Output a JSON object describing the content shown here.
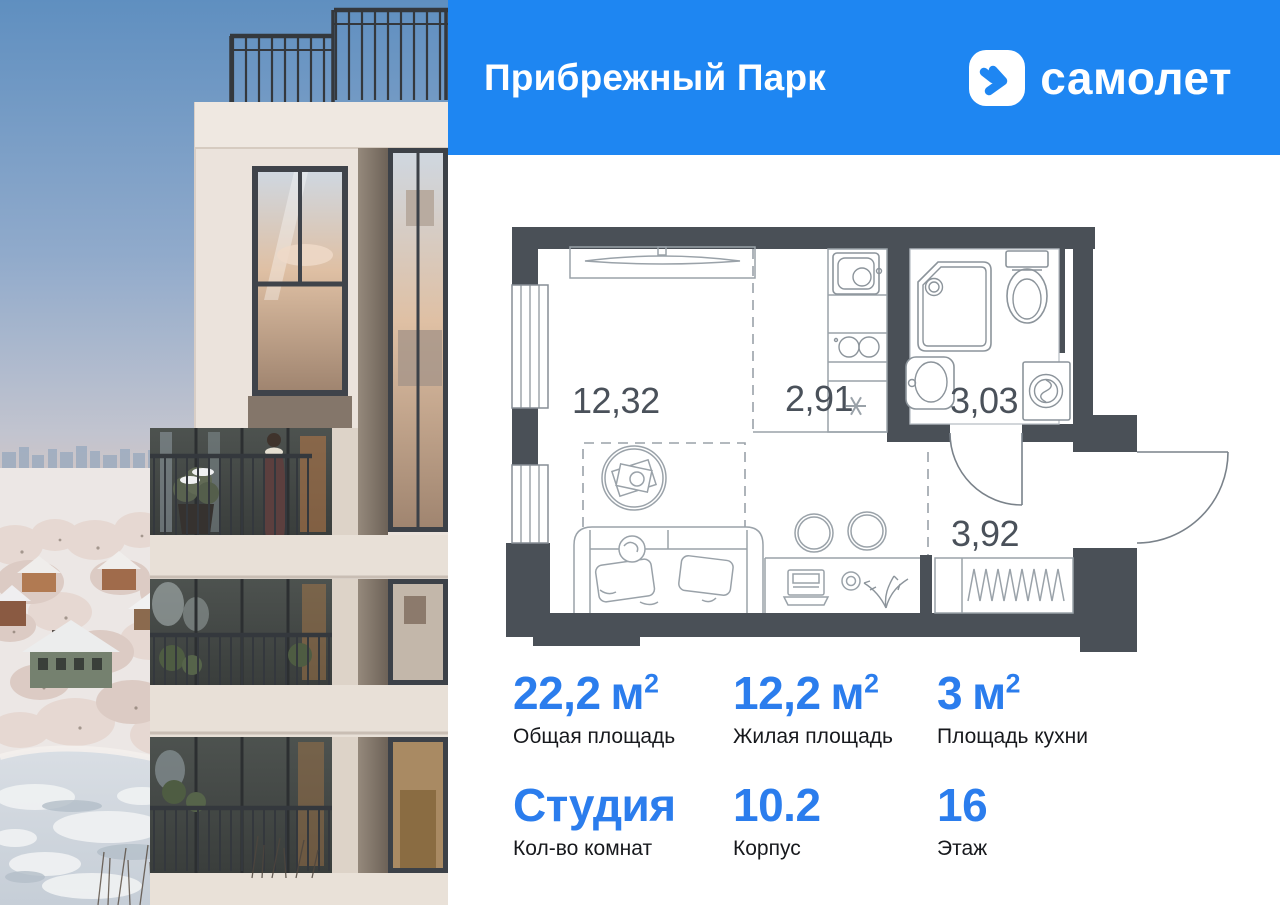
{
  "header": {
    "project_title": "Прибрежный Парк",
    "brand": "самолет",
    "header_bg": "#1e86f2"
  },
  "plan": {
    "areas": {
      "living": "12,32",
      "kitchen": "2,91",
      "bathroom": "3,03",
      "hallway": "3,92"
    },
    "wall_color": "#4a5057"
  },
  "stats": {
    "accent_color": "#2b7ded",
    "cells": [
      {
        "value": "22,2",
        "unit": "м",
        "unit_sup": "2",
        "label": "Общая площадь"
      },
      {
        "value": "12,2",
        "unit": "м",
        "unit_sup": "2",
        "label": "Жилая площадь"
      },
      {
        "value": "3",
        "unit": "м",
        "unit_sup": "2",
        "label": "Площадь кухни"
      },
      {
        "value": "Студия",
        "unit": "",
        "unit_sup": "",
        "label": "Кол-во комнат"
      },
      {
        "value": "10.2",
        "unit": "",
        "unit_sup": "",
        "label": "Корпус"
      },
      {
        "value": "16",
        "unit": "",
        "unit_sup": "",
        "label": "Этаж"
      }
    ]
  }
}
